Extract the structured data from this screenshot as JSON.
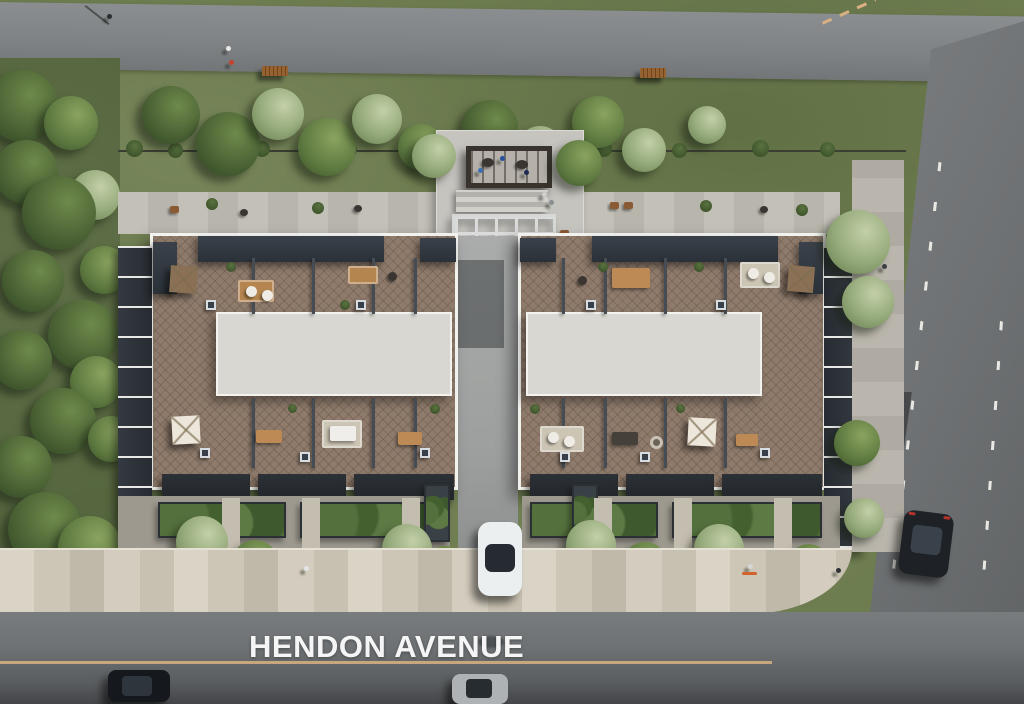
{
  "scene": {
    "type": "aerial-architectural-rendering",
    "street": {
      "label": "HENDON AVENUE"
    },
    "palette": {
      "avenue_asphalt": "#6e7173",
      "path_asphalt": "#85888a",
      "grass": "#6d7c4f",
      "park_grass": "#55663e",
      "sidewalk_paver": "#cfc8b9",
      "terrace_deck": "#8e7b6c",
      "roof_dark": "#31373e",
      "parapet_white": "#f2f2ef",
      "roof_slab": "#d8d7d2",
      "center_line": "#c9a77e",
      "tree_dark": "#44582f",
      "tree_sage": "#93a878"
    },
    "inventory": {
      "buildings": 2,
      "rooftop_terraces": "furnished with umbrellas, sofas, dining sets, planters and skylights",
      "pergola_lounge": 1,
      "park_benches": 2,
      "cars": [
        {
          "color": "dark",
          "location": "avenue-left"
        },
        {
          "color": "silver",
          "location": "avenue-center"
        },
        {
          "color": "white",
          "location": "driveway"
        },
        {
          "color": "dark",
          "location": "side-road"
        }
      ]
    }
  }
}
